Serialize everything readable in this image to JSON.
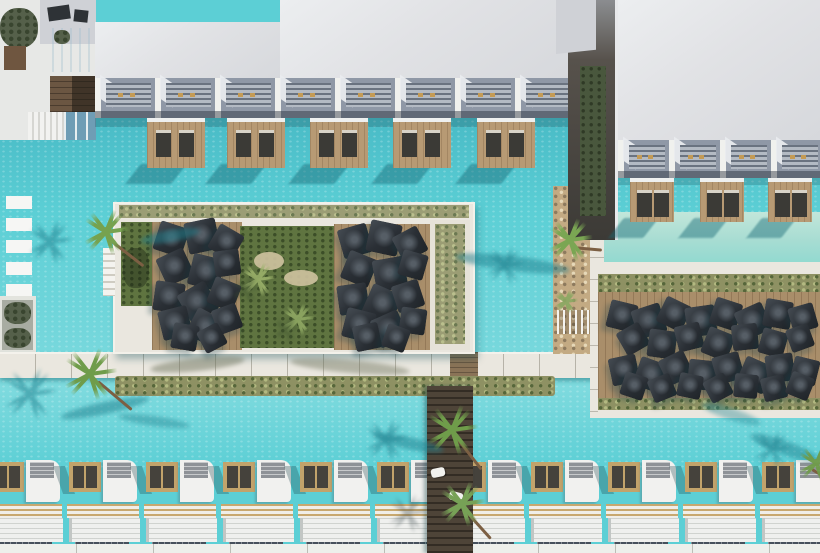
{
  "meta": {
    "title": "Aerial top-down photograph of a resort swim-up hotel complex with turquoise pools, umbrella sun decks, palm trees and rows of white cabanas",
    "type": "aerial-photograph",
    "no_visible_text": true
  },
  "colors": {
    "pool": "#5ccfd5",
    "pool_light": "#7edade",
    "pool_deep": "#46b8c4",
    "pool_pale": "#a6dcd2",
    "stone": "#eae7df",
    "stone_dim": "#d9d5c9",
    "wood_deck": "#a98e6a",
    "wood_walk": "#c3aa83",
    "wood_dark": "#4e4438",
    "terrace_wood": "#b79a74",
    "umbrella": "#2a2f35",
    "lawn": "#5f7440",
    "hedge": "#8e9163",
    "roof": "#e1e2e5",
    "roof_dim": "#cfd1d6",
    "balcony": "#8f98a6",
    "balcony_slat": "#6a7380",
    "white": "#f0f1ee",
    "bed_wood": "#c2a36b",
    "slat_gold": "#c8a86f",
    "glass": "#46505c",
    "shadow_teal": "#1f7f8d",
    "green_wall": "#49573d"
  },
  "top_building": {
    "balcony_count": 8,
    "balcony_width": 60,
    "terraces": [
      52,
      132,
      215,
      298,
      382
    ],
    "terrace_w": 58,
    "terrace_h": 46,
    "terrace_y": 118
  },
  "right_building": {
    "balcony_count": 4,
    "balcony_width": 51,
    "terraces": [
      16,
      86,
      154
    ],
    "terrace_w": 44,
    "terrace_h": 40,
    "terrace_y": 178
  },
  "island": {
    "umbrella_count": 28,
    "umbrellas": [
      [
        43,
        22,
        30,
        18
      ],
      [
        73,
        18,
        32,
        -12
      ],
      [
        99,
        26,
        28,
        30
      ],
      [
        47,
        50,
        30,
        -25
      ],
      [
        77,
        54,
        32,
        14
      ],
      [
        101,
        48,
        26,
        -8
      ],
      [
        41,
        80,
        30,
        8
      ],
      [
        69,
        84,
        32,
        -30
      ],
      [
        97,
        78,
        28,
        22
      ],
      [
        47,
        106,
        30,
        -14
      ],
      [
        77,
        110,
        30,
        28
      ],
      [
        101,
        104,
        26,
        -20
      ],
      [
        59,
        122,
        26,
        10
      ],
      [
        87,
        124,
        24,
        -28
      ],
      [
        227,
        24,
        30,
        -16
      ],
      [
        255,
        20,
        32,
        12
      ],
      [
        283,
        28,
        28,
        -28
      ],
      [
        231,
        52,
        30,
        22
      ],
      [
        261,
        56,
        32,
        -10
      ],
      [
        287,
        50,
        26,
        16
      ],
      [
        225,
        82,
        30,
        -8
      ],
      [
        253,
        86,
        32,
        24
      ],
      [
        281,
        80,
        28,
        -18
      ],
      [
        231,
        108,
        30,
        14
      ],
      [
        261,
        112,
        30,
        -24
      ],
      [
        287,
        106,
        26,
        8
      ],
      [
        241,
        122,
        26,
        -12
      ],
      [
        271,
        124,
        24,
        20
      ]
    ]
  },
  "right_deck": {
    "umbrella_count": 30,
    "umbrellas": [
      [
        10,
        40,
        28,
        14
      ],
      [
        36,
        44,
        30,
        -18
      ],
      [
        62,
        38,
        28,
        26
      ],
      [
        88,
        44,
        30,
        -8
      ],
      [
        114,
        38,
        28,
        18
      ],
      [
        140,
        44,
        30,
        -24
      ],
      [
        166,
        38,
        28,
        10
      ],
      [
        192,
        43,
        26,
        -16
      ],
      [
        22,
        64,
        26,
        -30
      ],
      [
        50,
        68,
        28,
        8
      ],
      [
        78,
        62,
        26,
        -14
      ],
      [
        106,
        68,
        28,
        22
      ],
      [
        134,
        62,
        26,
        -6
      ],
      [
        162,
        68,
        26,
        16
      ],
      [
        190,
        64,
        24,
        -20
      ],
      [
        12,
        94,
        28,
        -12
      ],
      [
        38,
        98,
        30,
        20
      ],
      [
        64,
        92,
        28,
        -26
      ],
      [
        90,
        98,
        30,
        6
      ],
      [
        116,
        92,
        28,
        -16
      ],
      [
        142,
        98,
        30,
        24
      ],
      [
        168,
        92,
        28,
        -8
      ],
      [
        194,
        96,
        26,
        14
      ],
      [
        24,
        112,
        24,
        18
      ],
      [
        52,
        114,
        24,
        -22
      ],
      [
        80,
        112,
        24,
        12
      ],
      [
        108,
        114,
        24,
        -28
      ],
      [
        136,
        112,
        24,
        6
      ],
      [
        164,
        114,
        24,
        -14
      ],
      [
        190,
        112,
        24,
        22
      ]
    ]
  },
  "cabanas": {
    "count": 11,
    "pitch": 77,
    "start_x": -12,
    "row_y": 456
  },
  "palms": [
    [
      106,
      230,
      46,
      "#76a24f",
      1
    ],
    [
      90,
      372,
      52,
      "#6f9c4a",
      1
    ],
    [
      258,
      278,
      34,
      "#9ab06a",
      0.9
    ],
    [
      298,
      318,
      32,
      "#8fa863",
      0.9
    ],
    [
      570,
      238,
      44,
      "#7aa653",
      1
    ],
    [
      452,
      428,
      50,
      "#6f9c4a",
      1
    ],
    [
      462,
      502,
      46,
      "#77a156",
      1
    ],
    [
      816,
      462,
      36,
      "#6f9c4a",
      0.95
    ],
    [
      566,
      300,
      24,
      "#8aa862",
      0.9
    ]
  ],
  "palm_shadows": [
    [
      50,
      240,
      46,
      "#1f7f8d",
      0.5
    ],
    [
      30,
      392,
      54,
      "#1f7f8d",
      0.5
    ],
    [
      505,
      264,
      40,
      "#1f7f8d",
      0.45
    ],
    [
      386,
      438,
      44,
      "#1f7f8d",
      0.45
    ],
    [
      408,
      512,
      40,
      "#39464a",
      0.35
    ],
    [
      246,
      288,
      30,
      "#3f5230",
      0.4
    ],
    [
      286,
      328,
      28,
      "#3f5230",
      0.38
    ],
    [
      772,
      448,
      40,
      "#1f7f8d",
      0.45
    ]
  ],
  "shadow_streaks": [
    [
      455,
      256,
      115,
      15,
      7,
      "#1f7f8d",
      0.5
    ],
    [
      372,
      437,
      72,
      12,
      12,
      "#1f7f8d",
      0.5
    ],
    [
      748,
      441,
      74,
      14,
      20,
      "#1f7f8d",
      0.45
    ],
    [
      700,
      408,
      62,
      12,
      18,
      "#2a8a96",
      0.4
    ],
    [
      150,
      358,
      95,
      13,
      -6,
      "#70755f",
      0.5
    ],
    [
      290,
      360,
      120,
      13,
      5,
      "#70755f",
      0.45
    ],
    [
      60,
      402,
      90,
      12,
      -12,
      "#1f7f8d",
      0.5
    ],
    [
      118,
      416,
      72,
      10,
      8,
      "#1f7f8d",
      0.4
    ],
    [
      140,
      230,
      60,
      12,
      -10,
      "#1f7f8d",
      0.5
    ]
  ],
  "trunks": [
    [
      112,
      240,
      40,
      38
    ],
    [
      98,
      380,
      44,
      40
    ],
    [
      572,
      246,
      30,
      5
    ],
    [
      458,
      438,
      38,
      52
    ],
    [
      468,
      512,
      34,
      48
    ],
    [
      812,
      468,
      26,
      30
    ]
  ]
}
